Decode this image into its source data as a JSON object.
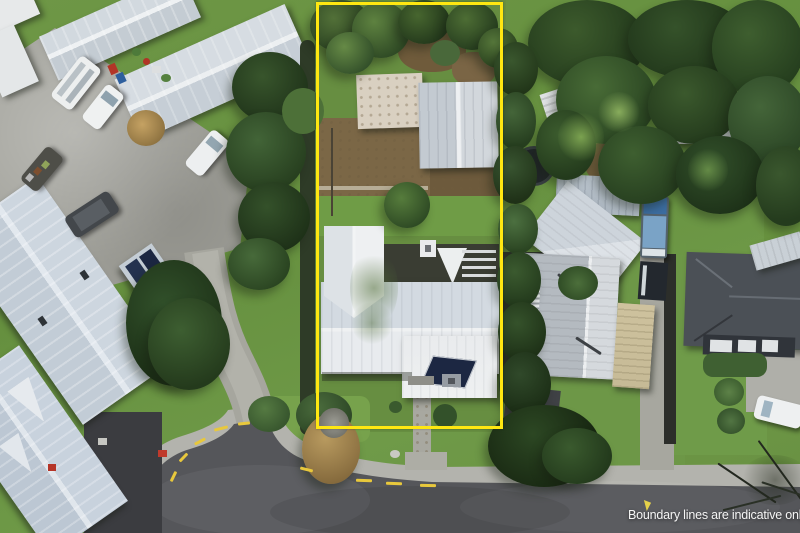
{
  "overlay": {
    "disclaimer": "Boundary lines are indicative only",
    "marker_icon": "cursor-pin-icon"
  },
  "boundary": {
    "color": "#ffe711",
    "shape": "rectangle",
    "style": "solid"
  },
  "scene": {
    "type": "aerial-drone-photograph",
    "subject": "residential-property-with-boundary-overlay",
    "elements": [
      "subject-property",
      "main-house",
      "garage",
      "shed",
      "back-garden",
      "front-lawn",
      "footpath",
      "cul-de-sac-road",
      "sidewalk",
      "curved-driveway",
      "neighbour-houses",
      "parked-cars",
      "camper-van",
      "trailer",
      "trampoline",
      "trees",
      "hedges",
      "solar-panels",
      "carport",
      "wheelie-bins",
      "road-markings"
    ]
  },
  "palette": {
    "grass": "#6c9544",
    "grass_bright": "#77a24c",
    "tree_dark": "#2c4423",
    "asphalt": "#55565a",
    "concrete": "#a6a69e",
    "sidewalk": "#b3b3ad",
    "roof_white": "#e7eaed",
    "roof_gray": "#c6ccd2",
    "roof_blue_gray": "#c8d1da",
    "roof_charcoal": "#4b5056",
    "roof_beige": "#cec29e",
    "dirt": "#7b6746",
    "solar_panel": "#1c2742",
    "road_marking": "#e8c83c",
    "text": "#f5f5f5"
  }
}
